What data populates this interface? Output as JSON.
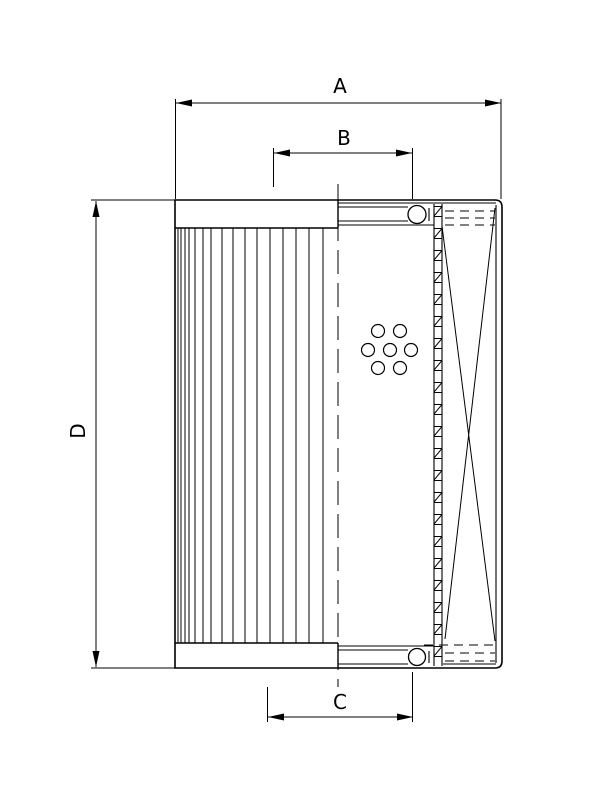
{
  "drawing": {
    "title": "Filter element cross-section technical drawing",
    "dim_labels": {
      "a": "A",
      "b": "B",
      "c": "C",
      "d": "D"
    },
    "colors": {
      "line": "#000000",
      "background": "#ffffff"
    }
  }
}
